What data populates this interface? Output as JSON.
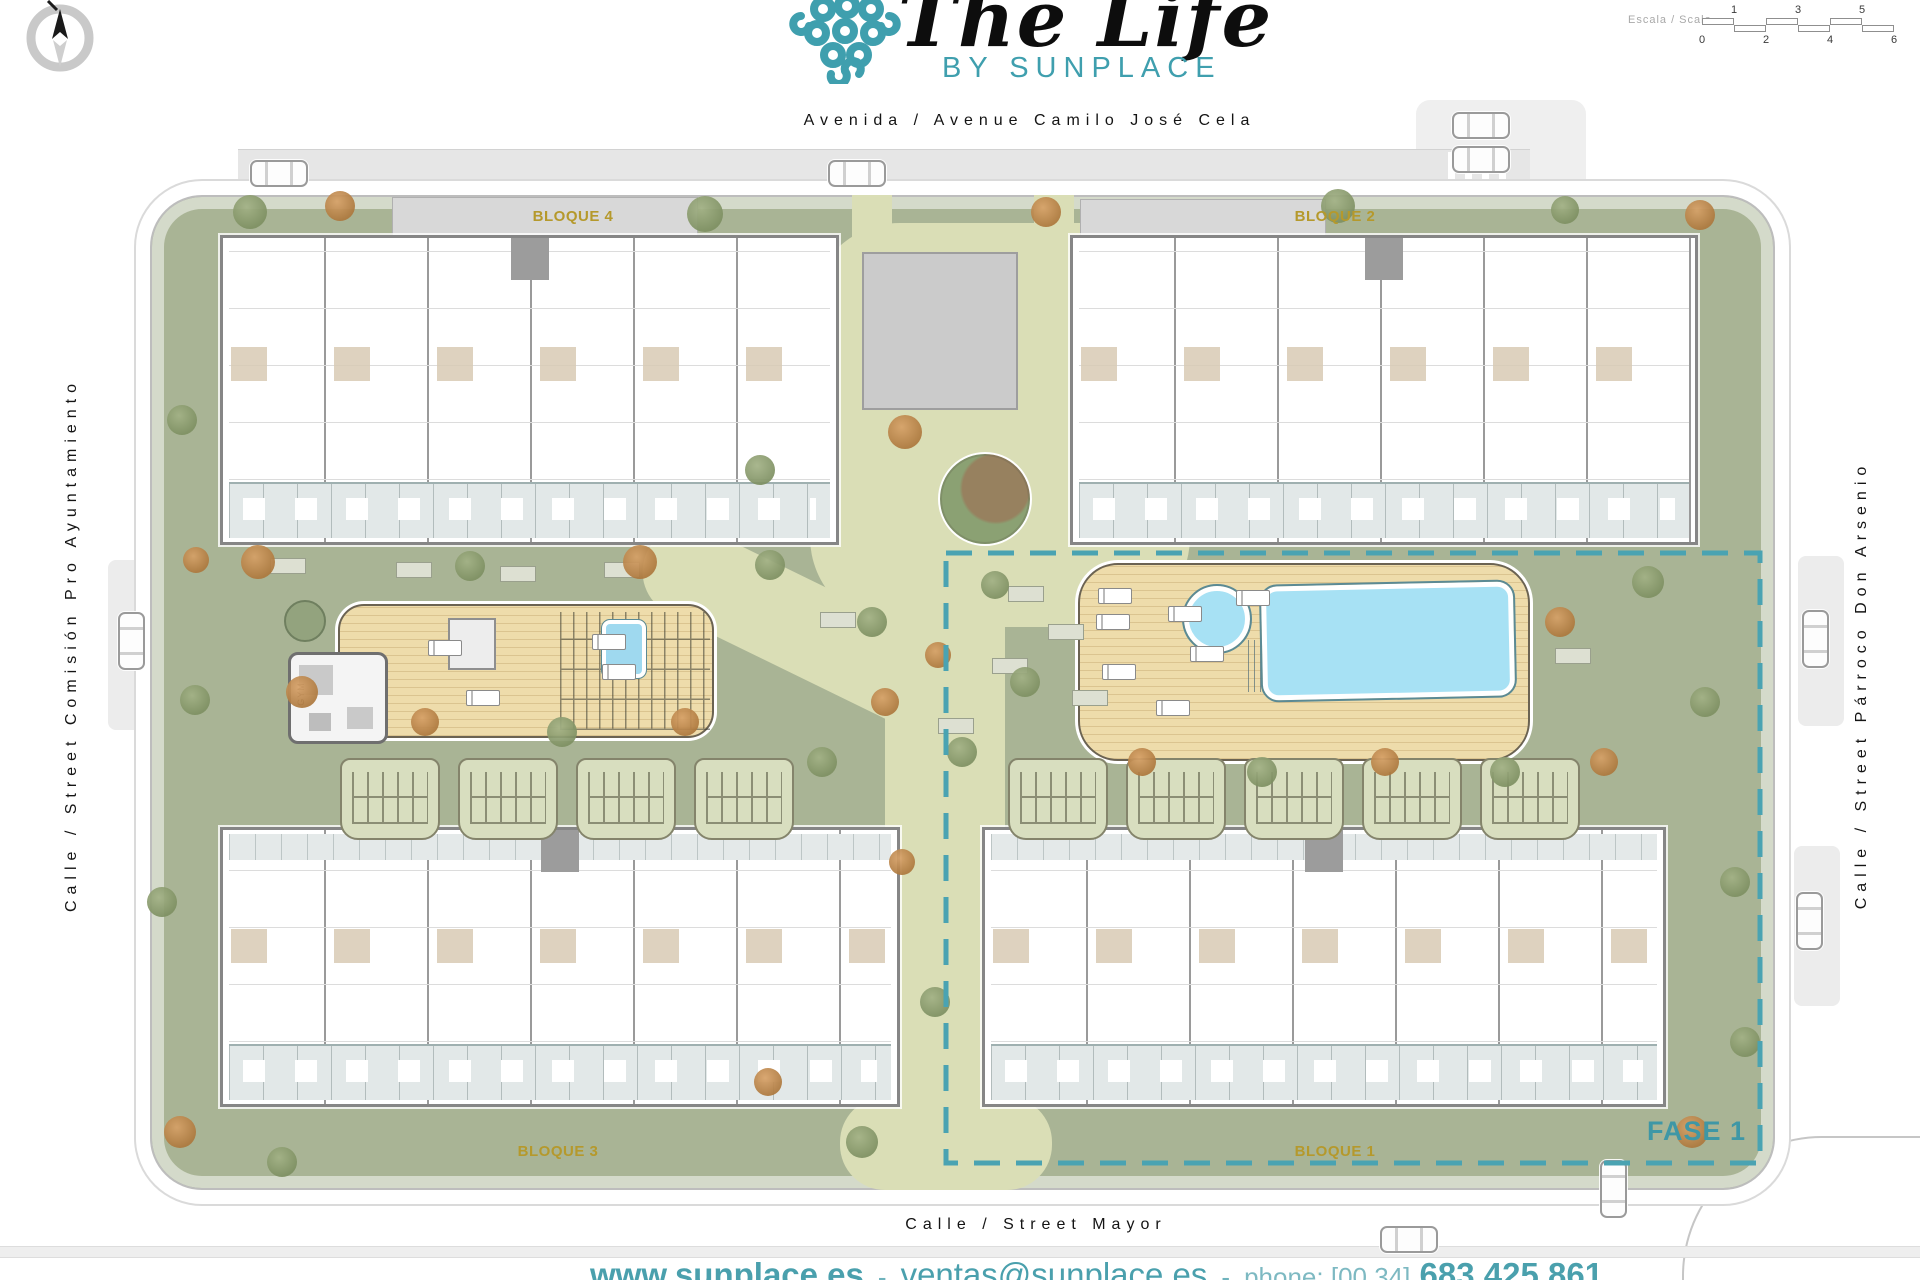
{
  "branding": {
    "title": "The Life",
    "subtitle": "BY SUNPLACE",
    "teal": "#3f9fae"
  },
  "scalebar": {
    "label": "Escala / Scale",
    "top_ticks": [
      "1",
      "3",
      "5"
    ],
    "bottom_ticks": [
      "0",
      "2",
      "4",
      "6"
    ]
  },
  "streets": {
    "top": "Avenida / Avenue Camilo José Cela",
    "left": "Calle / Street Comisión Pro Ayuntamiento",
    "right": "Calle / Street Párroco Don Arsenio",
    "bottom": "Calle / Street Mayor"
  },
  "blocks": [
    {
      "label": "BLOQUE 4"
    },
    {
      "label": "BLOQUE 2"
    },
    {
      "label": "BLOQUE 3"
    },
    {
      "label": "BLOQUE 1"
    }
  ],
  "phase": {
    "label": "FASE 1"
  },
  "amenities": {
    "gym_label": "GYM"
  },
  "footer": {
    "website": "www.sunplace.es",
    "separator": "-",
    "email": "ventas@sunplace.es",
    "phone_label": "phone: [00 34]",
    "phone_number": "683 425 861"
  },
  "colors": {
    "teal": "#3f9fae",
    "gold": "#b5992c",
    "lawn": "#a9b495",
    "path": "#dadeb6",
    "deck": "#eedcab",
    "pool": "#a7e1f4",
    "road": "#e6e6e6",
    "label_gold": "#b5992c"
  },
  "scene": {
    "trees": [
      {
        "x": 250,
        "y": 212,
        "s": 34,
        "v": "o"
      },
      {
        "x": 340,
        "y": 206,
        "s": 30,
        "v": "a"
      },
      {
        "x": 705,
        "y": 214,
        "s": 36,
        "v": "o"
      },
      {
        "x": 1046,
        "y": 212,
        "s": 30,
        "v": "a"
      },
      {
        "x": 1338,
        "y": 206,
        "s": 34,
        "v": "o"
      },
      {
        "x": 1565,
        "y": 210,
        "s": 28,
        "v": "o"
      },
      {
        "x": 1700,
        "y": 215,
        "s": 30,
        "v": "a"
      },
      {
        "x": 182,
        "y": 420,
        "s": 30,
        "v": "o"
      },
      {
        "x": 196,
        "y": 560,
        "s": 26,
        "v": "a"
      },
      {
        "x": 258,
        "y": 562,
        "s": 34,
        "v": "a"
      },
      {
        "x": 470,
        "y": 566,
        "s": 30,
        "v": "o"
      },
      {
        "x": 640,
        "y": 562,
        "s": 34,
        "v": "a"
      },
      {
        "x": 760,
        "y": 470,
        "s": 30,
        "v": "o"
      },
      {
        "x": 905,
        "y": 432,
        "s": 34,
        "v": "a"
      },
      {
        "x": 770,
        "y": 565,
        "s": 30,
        "v": "o"
      },
      {
        "x": 872,
        "y": 622,
        "s": 30,
        "v": "o"
      },
      {
        "x": 938,
        "y": 655,
        "s": 26,
        "v": "a"
      },
      {
        "x": 995,
        "y": 585,
        "s": 28,
        "v": "o"
      },
      {
        "x": 1025,
        "y": 682,
        "s": 30,
        "v": "o"
      },
      {
        "x": 885,
        "y": 702,
        "s": 28,
        "v": "a"
      },
      {
        "x": 962,
        "y": 752,
        "s": 30,
        "v": "o"
      },
      {
        "x": 195,
        "y": 700,
        "s": 30,
        "v": "o"
      },
      {
        "x": 302,
        "y": 692,
        "s": 32,
        "v": "a"
      },
      {
        "x": 425,
        "y": 722,
        "s": 28,
        "v": "a"
      },
      {
        "x": 562,
        "y": 732,
        "s": 30,
        "v": "o"
      },
      {
        "x": 685,
        "y": 722,
        "s": 28,
        "v": "a"
      },
      {
        "x": 822,
        "y": 762,
        "s": 30,
        "v": "o"
      },
      {
        "x": 1560,
        "y": 622,
        "s": 30,
        "v": "a"
      },
      {
        "x": 1648,
        "y": 582,
        "s": 32,
        "v": "o"
      },
      {
        "x": 1705,
        "y": 702,
        "s": 30,
        "v": "o"
      },
      {
        "x": 1604,
        "y": 762,
        "s": 28,
        "v": "a"
      },
      {
        "x": 1142,
        "y": 762,
        "s": 28,
        "v": "a"
      },
      {
        "x": 1262,
        "y": 772,
        "s": 30,
        "v": "o"
      },
      {
        "x": 1385,
        "y": 762,
        "s": 28,
        "v": "a"
      },
      {
        "x": 1505,
        "y": 772,
        "s": 30,
        "v": "o"
      },
      {
        "x": 162,
        "y": 902,
        "s": 30,
        "v": "o"
      },
      {
        "x": 180,
        "y": 1132,
        "s": 32,
        "v": "a"
      },
      {
        "x": 282,
        "y": 1162,
        "s": 30,
        "v": "o"
      },
      {
        "x": 768,
        "y": 1082,
        "s": 28,
        "v": "a"
      },
      {
        "x": 862,
        "y": 1142,
        "s": 32,
        "v": "o"
      },
      {
        "x": 935,
        "y": 1002,
        "s": 30,
        "v": "o"
      },
      {
        "x": 1692,
        "y": 1132,
        "s": 32,
        "v": "a"
      },
      {
        "x": 1745,
        "y": 1042,
        "s": 30,
        "v": "o"
      },
      {
        "x": 1735,
        "y": 882,
        "s": 30,
        "v": "o"
      },
      {
        "x": 902,
        "y": 862,
        "s": 26,
        "v": "a"
      }
    ],
    "cars": [
      {
        "x": 250,
        "y": 160,
        "o": "h"
      },
      {
        "x": 828,
        "y": 160,
        "o": "h"
      },
      {
        "x": 1452,
        "y": 112,
        "o": "h"
      },
      {
        "x": 1452,
        "y": 146,
        "o": "h"
      },
      {
        "x": 118,
        "y": 612,
        "o": "v"
      },
      {
        "x": 1802,
        "y": 610,
        "o": "v"
      },
      {
        "x": 1796,
        "y": 892,
        "o": "v"
      },
      {
        "x": 1600,
        "y": 1160,
        "o": "v"
      },
      {
        "x": 1380,
        "y": 1226,
        "o": "h"
      }
    ],
    "pergolas": [
      {
        "x": 340,
        "y": 758
      },
      {
        "x": 458,
        "y": 758
      },
      {
        "x": 576,
        "y": 758
      },
      {
        "x": 694,
        "y": 758
      },
      {
        "x": 1008,
        "y": 758
      },
      {
        "x": 1126,
        "y": 758
      },
      {
        "x": 1244,
        "y": 758
      },
      {
        "x": 1362,
        "y": 758
      },
      {
        "x": 1480,
        "y": 758
      }
    ],
    "loungers": [
      {
        "x": 1098,
        "y": 588
      },
      {
        "x": 1096,
        "y": 614
      },
      {
        "x": 1168,
        "y": 606
      },
      {
        "x": 1102,
        "y": 664
      },
      {
        "x": 1190,
        "y": 646
      },
      {
        "x": 1156,
        "y": 700
      },
      {
        "x": 1236,
        "y": 590
      },
      {
        "x": 428,
        "y": 640
      },
      {
        "x": 592,
        "y": 634
      },
      {
        "x": 602,
        "y": 664
      },
      {
        "x": 466,
        "y": 690
      }
    ],
    "benches": [
      {
        "x": 270,
        "y": 558
      },
      {
        "x": 396,
        "y": 562
      },
      {
        "x": 500,
        "y": 566
      },
      {
        "x": 604,
        "y": 562
      },
      {
        "x": 1008,
        "y": 586
      },
      {
        "x": 1048,
        "y": 624
      },
      {
        "x": 992,
        "y": 658
      },
      {
        "x": 1072,
        "y": 690
      },
      {
        "x": 938,
        "y": 718
      },
      {
        "x": 820,
        "y": 612
      },
      {
        "x": 1555,
        "y": 648
      }
    ]
  }
}
